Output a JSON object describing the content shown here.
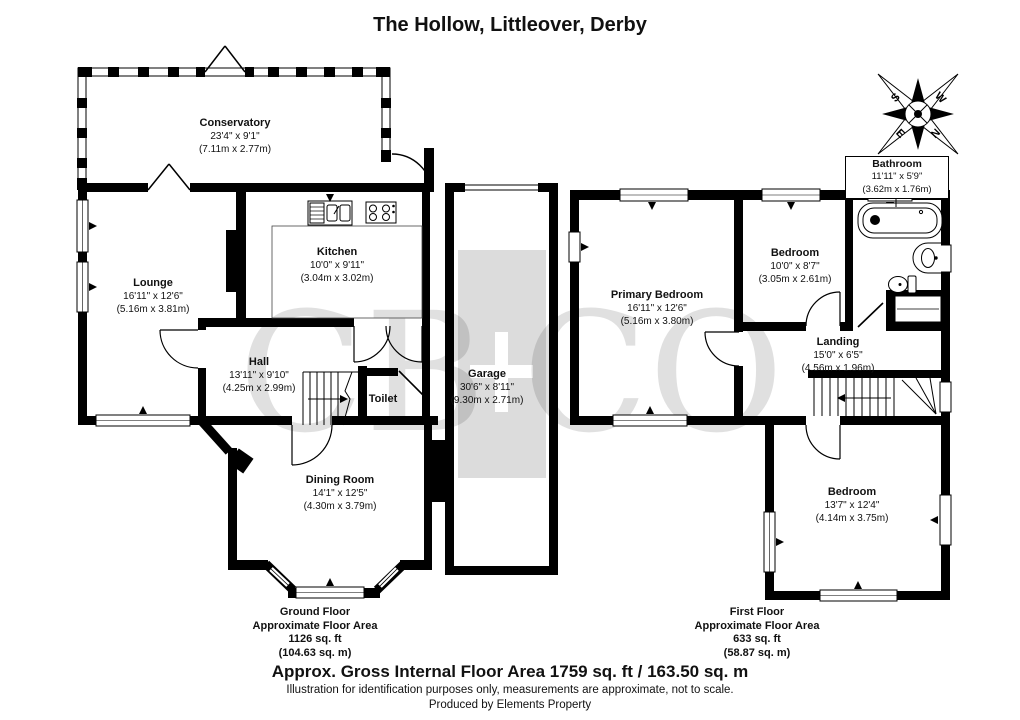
{
  "title": "The Hollow, Littleover, Derby",
  "watermark": {
    "left": "CB",
    "right": "CO"
  },
  "compass": {
    "n": "N",
    "s": "S",
    "e": "E",
    "w": "W"
  },
  "ground": {
    "rooms": {
      "conservatory": {
        "name": "Conservatory",
        "imperial": "23'4\" x 9'1\"",
        "metric": "(7.11m x 2.77m)"
      },
      "lounge": {
        "name": "Lounge",
        "imperial": "16'11\" x 12'6\"",
        "metric": "(5.16m x 3.81m)"
      },
      "kitchen": {
        "name": "Kitchen",
        "imperial": "10'0\" x 9'11\"",
        "metric": "(3.04m x 3.02m)"
      },
      "hall": {
        "name": "Hall",
        "imperial": "13'11\" x 9'10\"",
        "metric": "(4.25m x 2.99m)"
      },
      "toilet": {
        "name": "Toilet"
      },
      "dining": {
        "name": "Dining Room",
        "imperial": "14'1\" x 12'5\"",
        "metric": "(4.30m x 3.79m)"
      },
      "garage": {
        "name": "Garage",
        "imperial": "30'6\" x 8'11\"",
        "metric": "(9.30m x 2.71m)"
      }
    },
    "summary": {
      "line1": "Ground Floor",
      "line2": "Approximate Floor Area",
      "line3": "1126 sq. ft",
      "line4": "(104.63 sq. m)"
    }
  },
  "first": {
    "rooms": {
      "primary": {
        "name": "Primary Bedroom",
        "imperial": "16'11\" x 12'6\"",
        "metric": "(5.16m x 3.80m)"
      },
      "bedroom2": {
        "name": "Bedroom",
        "imperial": "10'0\" x 8'7\"",
        "metric": "(3.05m x 2.61m)"
      },
      "bathroom": {
        "name": "Bathroom",
        "imperial": "11'11\" x 5'9\"",
        "metric": "(3.62m x 1.76m)"
      },
      "landing": {
        "name": "Landing",
        "imperial": "15'0\" x 6'5\"",
        "metric": "(4.56m x 1.96m)"
      },
      "bedroom3": {
        "name": "Bedroom",
        "imperial": "13'7\" x 12'4\"",
        "metric": "(4.14m x 3.75m)"
      }
    },
    "summary": {
      "line1": "First Floor",
      "line2": "Approximate Floor Area",
      "line3": "633 sq. ft",
      "line4": "(58.87 sq. m)"
    }
  },
  "footer": {
    "gross_area": "Approx. Gross Internal Floor Area 1759 sq. ft / 163.50 sq. m",
    "disclaimer": "Illustration for identification purposes only, measurements are approximate, not to scale.",
    "producer": "Produced by Elements Property"
  }
}
